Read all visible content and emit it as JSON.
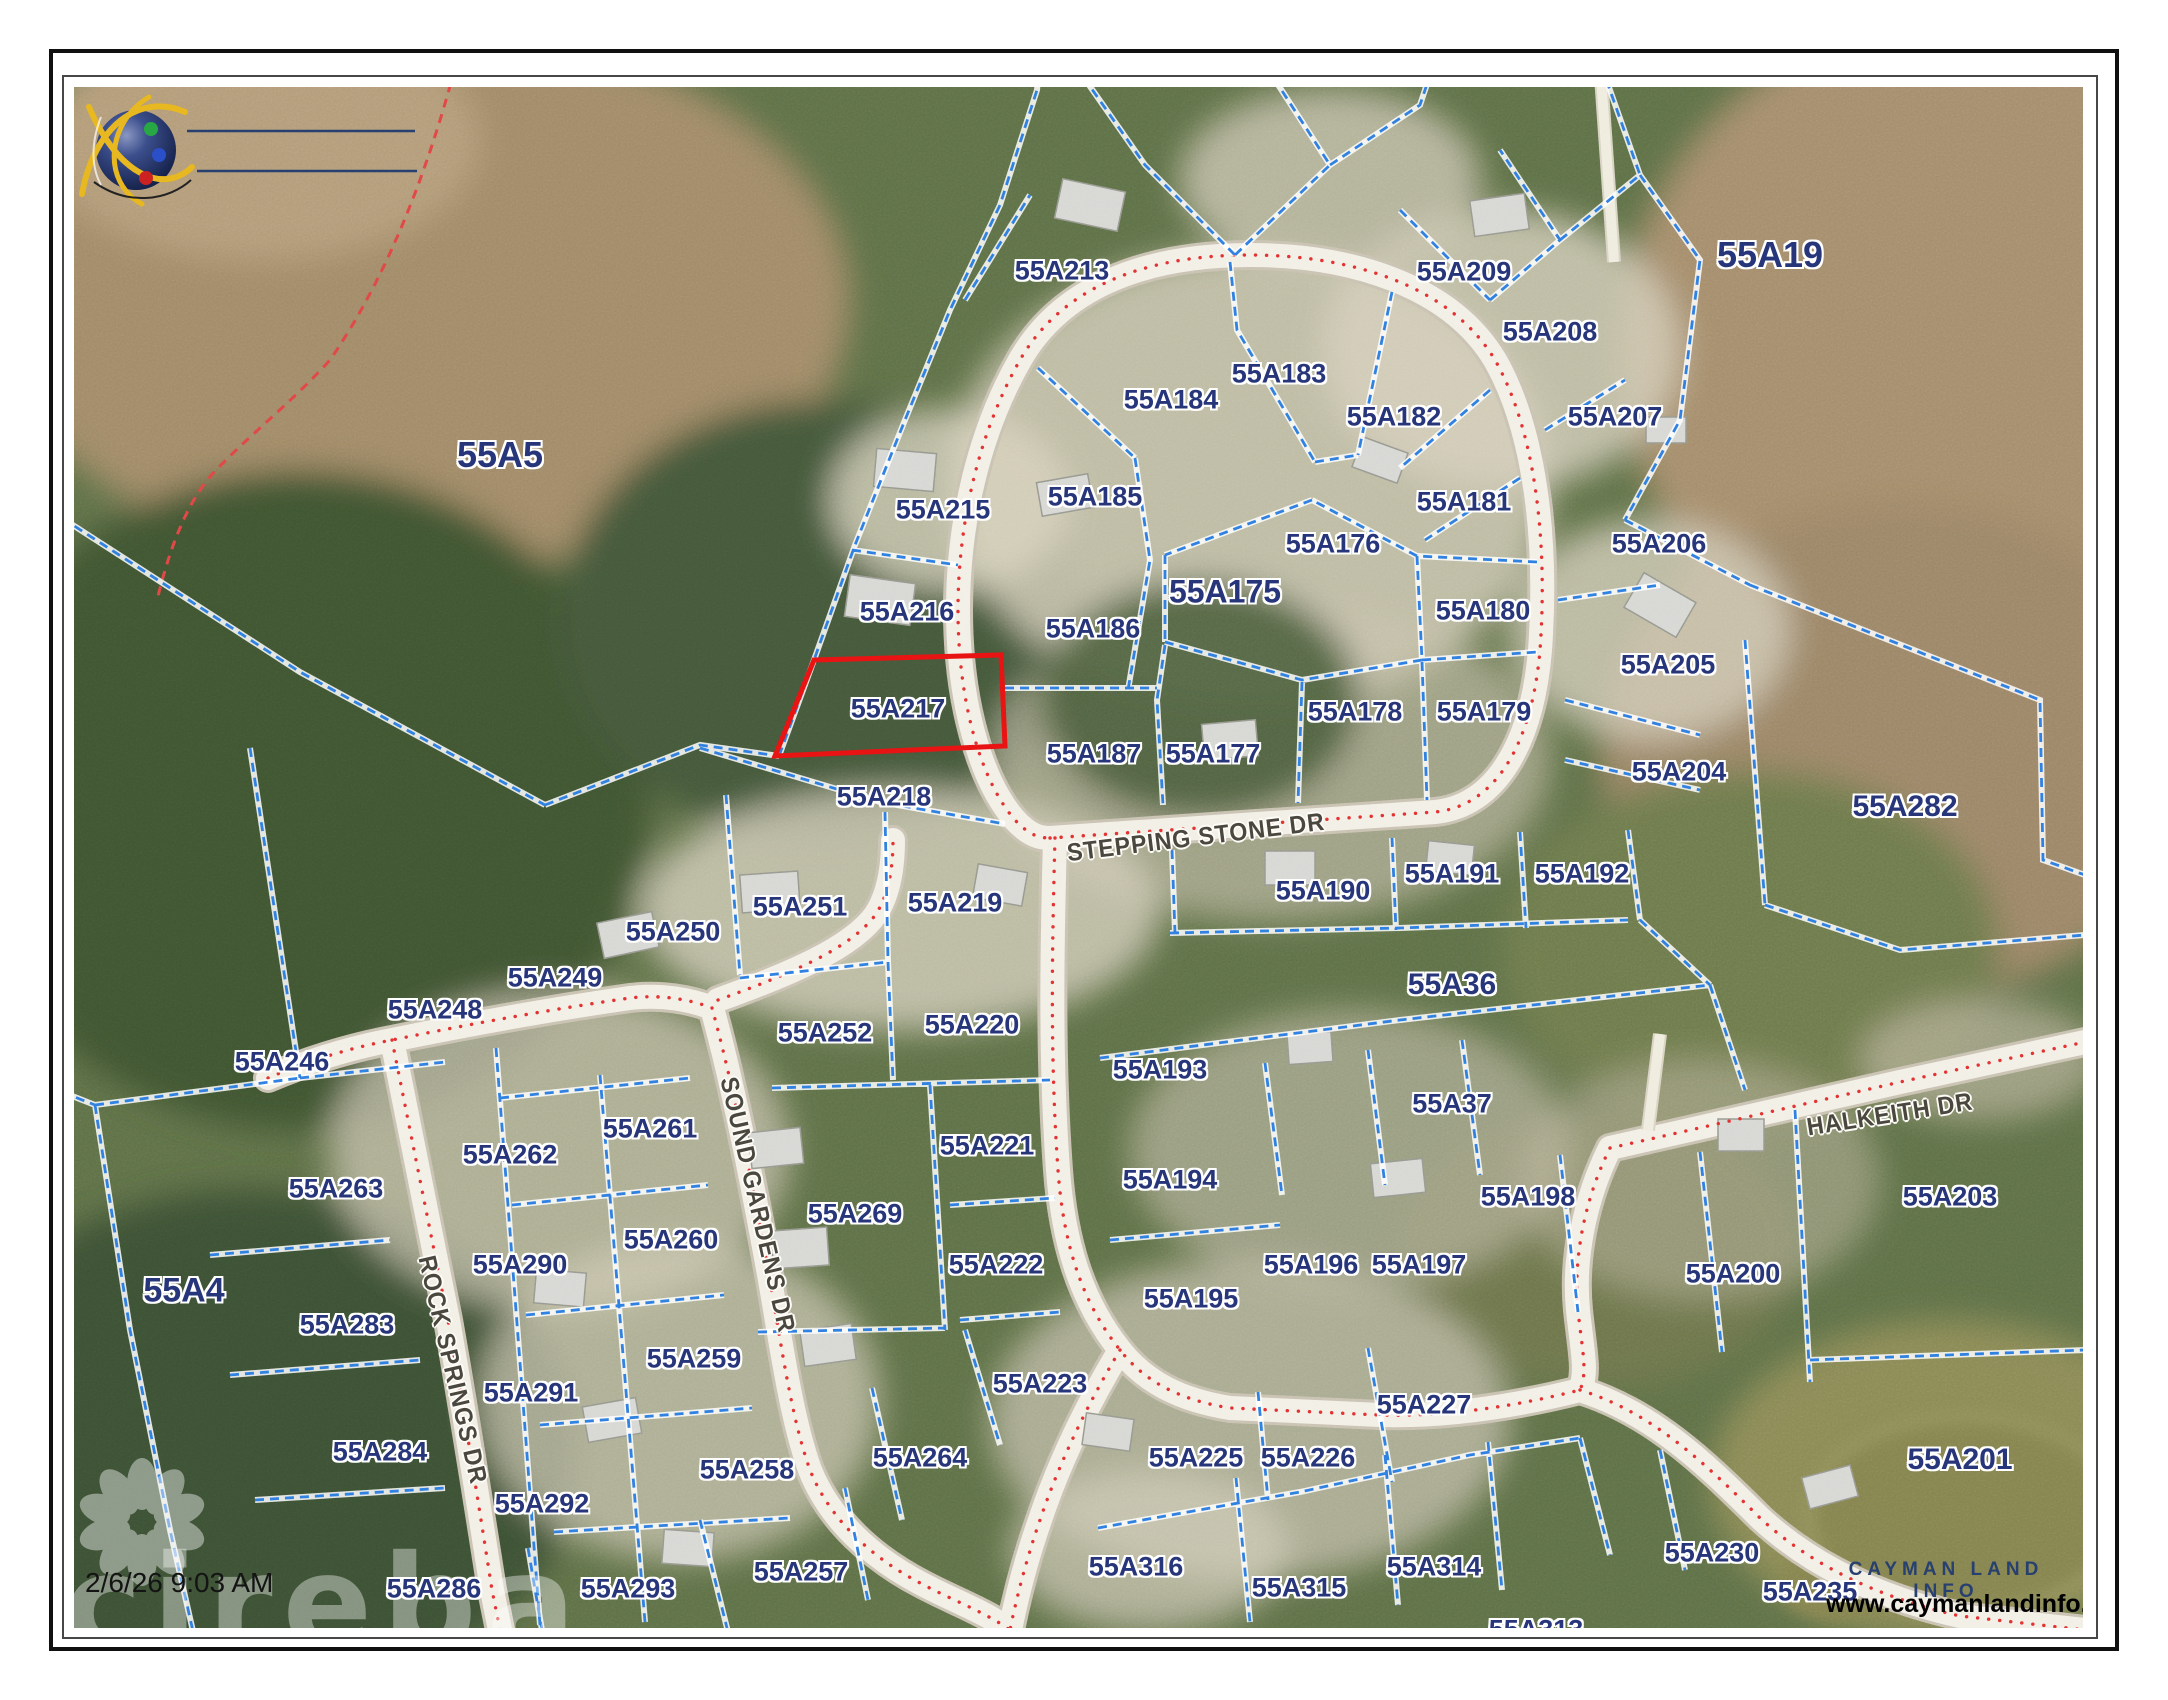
{
  "page": {
    "timestamp": "2/6/26 9:03 AM",
    "watermark": "cireba"
  },
  "branding": {
    "company": "CAYMAN LAND INFO",
    "website": "www.caymanlandinfo.ky"
  },
  "map": {
    "highlighted_parcel": "55A217",
    "colors": {
      "parcel_line": "#2e7ce0",
      "parcel_label": "#27357a",
      "highlight_outline": "#e81212",
      "road_centerline": "#e23030",
      "street_label": "#4a473f",
      "road_fill": "#f2efe6"
    },
    "streets": [
      {
        "name": "STEPPING STONE DR",
        "x": 1196,
        "y": 838,
        "rot": -7
      },
      {
        "name": "HALKEITH DR",
        "x": 1890,
        "y": 1115,
        "rot": -9
      },
      {
        "name": "ROCK SPRINGS DR",
        "x": 452,
        "y": 1370,
        "rot": 77
      },
      {
        "name": "SOUND GARDENS DR",
        "x": 757,
        "y": 1205,
        "rot": 77
      }
    ],
    "parcels": [
      {
        "id": "55A5",
        "x": 500,
        "y": 455,
        "s": 36
      },
      {
        "id": "55A213",
        "x": 1062,
        "y": 271
      },
      {
        "id": "55A209",
        "x": 1464,
        "y": 272
      },
      {
        "id": "55A208",
        "x": 1550,
        "y": 332
      },
      {
        "id": "55A19",
        "x": 1770,
        "y": 255,
        "s": 36
      },
      {
        "id": "55A184",
        "x": 1171,
        "y": 400
      },
      {
        "id": "55A183",
        "x": 1279,
        "y": 374
      },
      {
        "id": "55A182",
        "x": 1394,
        "y": 417
      },
      {
        "id": "55A207",
        "x": 1615,
        "y": 417
      },
      {
        "id": "55A215",
        "x": 943,
        "y": 510
      },
      {
        "id": "55A185",
        "x": 1095,
        "y": 497
      },
      {
        "id": "55A176",
        "x": 1333,
        "y": 544
      },
      {
        "id": "55A181",
        "x": 1464,
        "y": 502
      },
      {
        "id": "55A206",
        "x": 1659,
        "y": 544
      },
      {
        "id": "55A216",
        "x": 907,
        "y": 612
      },
      {
        "id": "55A186",
        "x": 1093,
        "y": 629
      },
      {
        "id": "55A175",
        "x": 1225,
        "y": 592,
        "s": 32
      },
      {
        "id": "55A180",
        "x": 1483,
        "y": 611
      },
      {
        "id": "55A205",
        "x": 1668,
        "y": 665
      },
      {
        "id": "55A217",
        "x": 898,
        "y": 709
      },
      {
        "id": "55A178",
        "x": 1355,
        "y": 712
      },
      {
        "id": "55A179",
        "x": 1484,
        "y": 712
      },
      {
        "id": "55A177",
        "x": 1213,
        "y": 754
      },
      {
        "id": "55A187",
        "x": 1094,
        "y": 754
      },
      {
        "id": "55A204",
        "x": 1679,
        "y": 772
      },
      {
        "id": "55A218",
        "x": 884,
        "y": 797
      },
      {
        "id": "55A282",
        "x": 1905,
        "y": 807,
        "s": 30
      },
      {
        "id": "55A250",
        "x": 673,
        "y": 932
      },
      {
        "id": "55A251",
        "x": 800,
        "y": 907
      },
      {
        "id": "55A219",
        "x": 955,
        "y": 903
      },
      {
        "id": "55A190",
        "x": 1323,
        "y": 891
      },
      {
        "id": "55A191",
        "x": 1452,
        "y": 874
      },
      {
        "id": "55A192",
        "x": 1582,
        "y": 874
      },
      {
        "id": "55A249",
        "x": 555,
        "y": 978
      },
      {
        "id": "55A248",
        "x": 435,
        "y": 1010
      },
      {
        "id": "55A246",
        "x": 282,
        "y": 1062
      },
      {
        "id": "55A252",
        "x": 825,
        "y": 1033
      },
      {
        "id": "55A220",
        "x": 972,
        "y": 1025
      },
      {
        "id": "55A36",
        "x": 1452,
        "y": 985,
        "s": 30
      },
      {
        "id": "55A193",
        "x": 1160,
        "y": 1070
      },
      {
        "id": "55A261",
        "x": 650,
        "y": 1129
      },
      {
        "id": "55A262",
        "x": 510,
        "y": 1155
      },
      {
        "id": "55A263",
        "x": 336,
        "y": 1189
      },
      {
        "id": "55A221",
        "x": 987,
        "y": 1146
      },
      {
        "id": "55A194",
        "x": 1170,
        "y": 1180
      },
      {
        "id": "55A37",
        "x": 1452,
        "y": 1104
      },
      {
        "id": "55A269",
        "x": 855,
        "y": 1214
      },
      {
        "id": "55A198",
        "x": 1528,
        "y": 1197
      },
      {
        "id": "55A203",
        "x": 1950,
        "y": 1197
      },
      {
        "id": "55A290",
        "x": 520,
        "y": 1265
      },
      {
        "id": "55A260",
        "x": 671,
        "y": 1240
      },
      {
        "id": "55A222",
        "x": 996,
        "y": 1265
      },
      {
        "id": "55A196",
        "x": 1311,
        "y": 1265
      },
      {
        "id": "55A197",
        "x": 1419,
        "y": 1265
      },
      {
        "id": "55A195",
        "x": 1191,
        "y": 1299
      },
      {
        "id": "55A200",
        "x": 1733,
        "y": 1274
      },
      {
        "id": "55A4",
        "x": 184,
        "y": 1291,
        "s": 34
      },
      {
        "id": "55A283",
        "x": 347,
        "y": 1325
      },
      {
        "id": "55A259",
        "x": 694,
        "y": 1359
      },
      {
        "id": "55A223",
        "x": 1040,
        "y": 1384
      },
      {
        "id": "55A291",
        "x": 531,
        "y": 1393
      },
      {
        "id": "55A284",
        "x": 380,
        "y": 1452
      },
      {
        "id": "55A227",
        "x": 1424,
        "y": 1405
      },
      {
        "id": "55A225",
        "x": 1196,
        "y": 1458
      },
      {
        "id": "55A226",
        "x": 1308,
        "y": 1458
      },
      {
        "id": "55A201",
        "x": 1960,
        "y": 1460,
        "s": 30
      },
      {
        "id": "55A258",
        "x": 747,
        "y": 1470
      },
      {
        "id": "55A264",
        "x": 920,
        "y": 1458
      },
      {
        "id": "55A292",
        "x": 542,
        "y": 1504
      },
      {
        "id": "55A286",
        "x": 434,
        "y": 1589
      },
      {
        "id": "55A293",
        "x": 628,
        "y": 1589
      },
      {
        "id": "55A257",
        "x": 801,
        "y": 1572
      },
      {
        "id": "55A316",
        "x": 1136,
        "y": 1567
      },
      {
        "id": "55A315",
        "x": 1299,
        "y": 1588
      },
      {
        "id": "55A314",
        "x": 1434,
        "y": 1567
      },
      {
        "id": "55A313",
        "x": 1536,
        "y": 1630
      },
      {
        "id": "55A230",
        "x": 1712,
        "y": 1553
      },
      {
        "id": "55A235",
        "x": 1810,
        "y": 1592
      }
    ]
  }
}
